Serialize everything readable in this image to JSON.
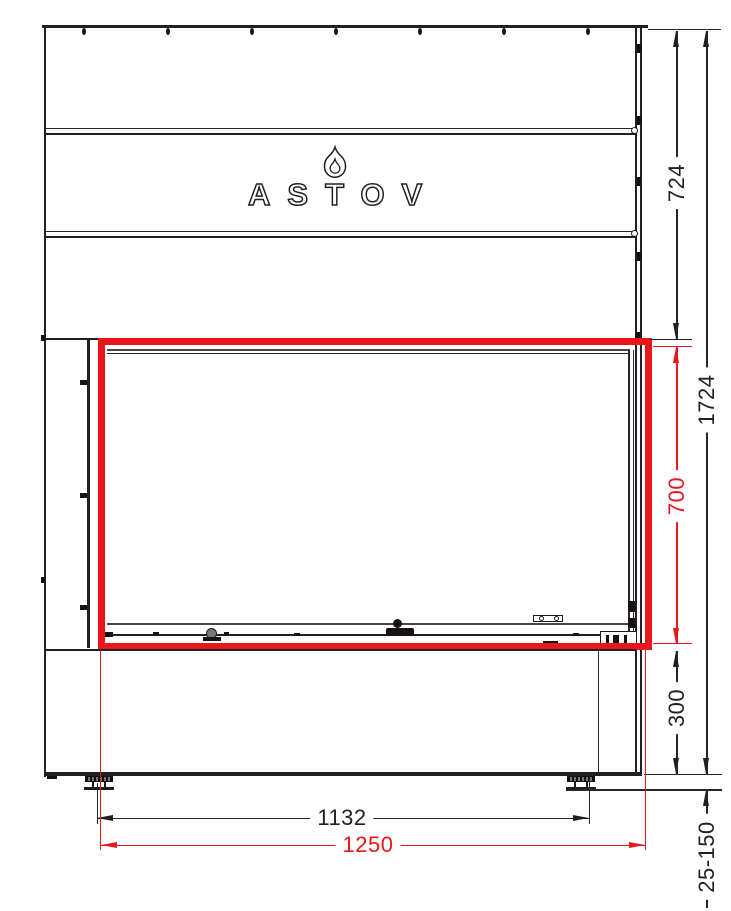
{
  "drawing": {
    "type": "fireplace front-view technical drawing",
    "logo": {
      "text": "ASTOV",
      "icon": "flame-icon"
    },
    "colors": {
      "line": "#231f20",
      "highlight": "#e8171d",
      "background": "#ffffff"
    },
    "dims": {
      "d724": {
        "label": "724",
        "orientation": "vertical",
        "color": "#231f20",
        "measures": "upper body height"
      },
      "d1724": {
        "label": "1724",
        "orientation": "vertical",
        "color": "#231f20",
        "measures": "total height"
      },
      "d700": {
        "label": "700",
        "orientation": "vertical",
        "color": "#e8171d",
        "measures": "glass opening height"
      },
      "d300": {
        "label": "300",
        "orientation": "vertical",
        "color": "#231f20",
        "measures": "base height"
      },
      "d25150": {
        "label": "25-150",
        "orientation": "vertical",
        "color": "#231f20",
        "measures": "adjustable feet range"
      },
      "d1132": {
        "label": "1132",
        "orientation": "horizontal",
        "color": "#231f20",
        "measures": "feet span"
      },
      "d1250": {
        "label": "1250",
        "orientation": "horizontal",
        "color": "#e8171d",
        "measures": "glass opening width"
      }
    }
  }
}
